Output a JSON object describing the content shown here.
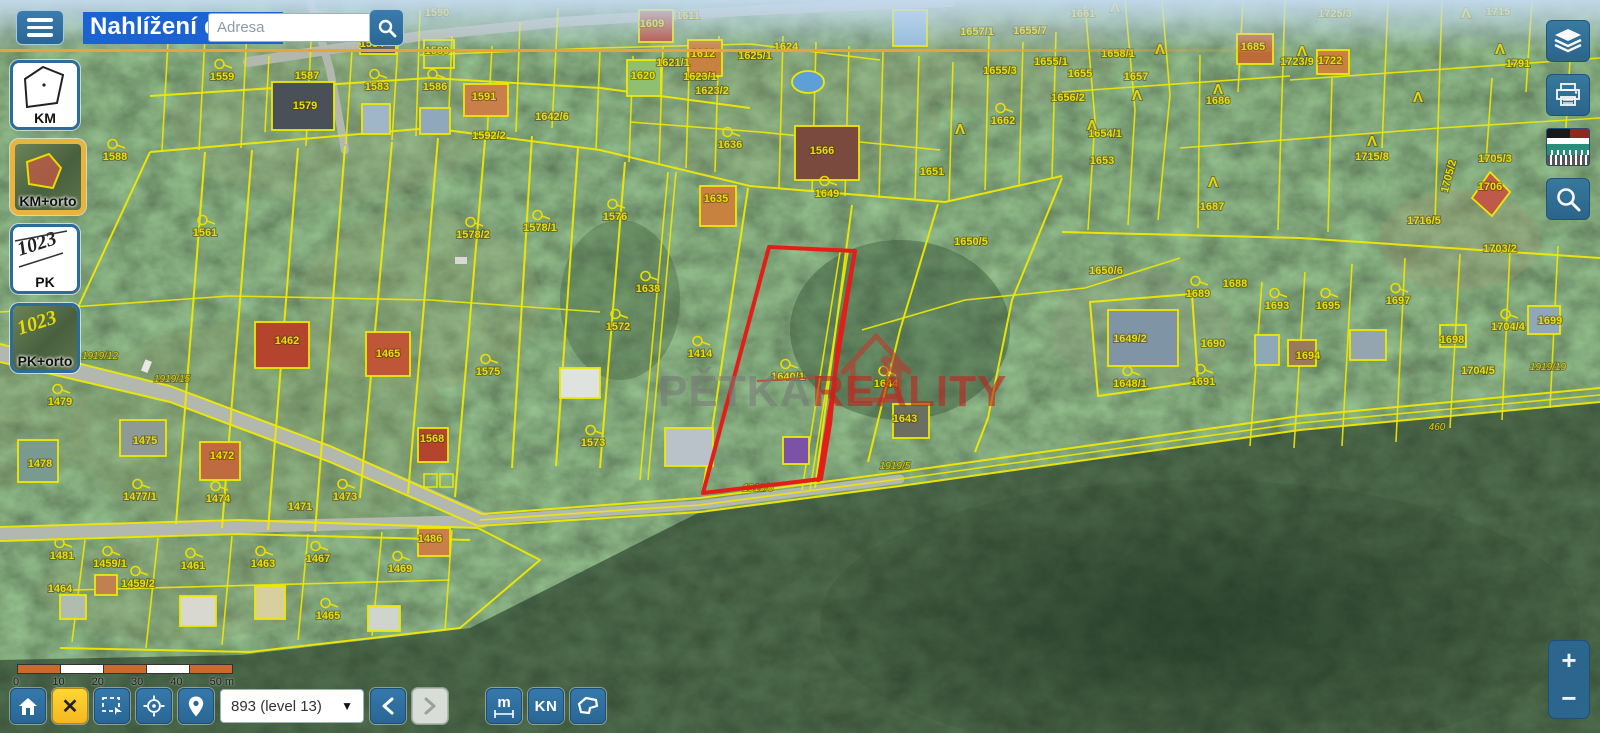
{
  "header": {
    "title": "Nahlížení do KN",
    "search_placeholder": "Adresa"
  },
  "layer_buttons": [
    {
      "id": "km",
      "label": "KM",
      "active": false
    },
    {
      "id": "km-orto",
      "label": "KM+orto",
      "active": true
    },
    {
      "id": "pk",
      "label": "PK",
      "active": false
    },
    {
      "id": "pk-orto",
      "label": "PK+orto",
      "active": false
    }
  ],
  "layer_thumb_text": {
    "pk": "1023",
    "pk_orto": "1023"
  },
  "right_tools": [
    {
      "id": "layers",
      "name": "map-layers"
    },
    {
      "id": "print",
      "name": "print-map"
    },
    {
      "id": "legend",
      "name": "legend-preview"
    },
    {
      "id": "search",
      "name": "search-map"
    }
  ],
  "toolbar": {
    "clear_label": "✕",
    "measure_label": "m",
    "kn_label": "KN",
    "zoom_level": "893 (level 13)",
    "caret": "▼"
  },
  "scalebar": {
    "ticks": [
      "0",
      "10",
      "20",
      "30",
      "40"
    ],
    "last_tick": "50 m"
  },
  "zoom_controls": {
    "plus": "+",
    "minus": "−"
  },
  "watermark": {
    "part1": "PĚTKA",
    "part2": "REALITY"
  },
  "colors": {
    "accent_blue": "#2a6694",
    "active_orange": "#e9b43d",
    "parcel_yellow": "#efe900",
    "selected_red": "#e31e18",
    "warn_yellow": "#f4b81f",
    "scale_orange": "#c96a2e"
  },
  "map": {
    "labels": [
      {
        "t": "1559",
        "x": 222,
        "y": 80,
        "f": 1
      },
      {
        "t": "1587",
        "x": 307,
        "y": 79
      },
      {
        "t": "1579",
        "x": 305,
        "y": 109
      },
      {
        "t": "1584",
        "x": 372,
        "y": 47
      },
      {
        "t": "1583",
        "x": 377,
        "y": 90,
        "f": 1
      },
      {
        "t": "1590",
        "x": 437,
        "y": 16
      },
      {
        "t": "1589",
        "x": 437,
        "y": 54
      },
      {
        "t": "1586",
        "x": 435,
        "y": 90,
        "f": 1
      },
      {
        "t": "1591",
        "x": 484,
        "y": 100
      },
      {
        "t": "1592/2",
        "x": 489,
        "y": 139
      },
      {
        "t": "1642/6",
        "x": 552,
        "y": 120
      },
      {
        "t": "1588",
        "x": 115,
        "y": 160,
        "f": 1
      },
      {
        "t": "1561",
        "x": 205,
        "y": 236,
        "f": 1
      },
      {
        "t": "1578/2",
        "x": 473,
        "y": 238,
        "f": 1
      },
      {
        "t": "1578/1",
        "x": 540,
        "y": 231,
        "f": 1
      },
      {
        "t": "1576",
        "x": 615,
        "y": 220,
        "f": 1
      },
      {
        "t": "1575",
        "x": 488,
        "y": 375,
        "f": 1
      },
      {
        "t": "1572",
        "x": 618,
        "y": 330,
        "f": 1
      },
      {
        "t": "1573",
        "x": 593,
        "y": 446,
        "f": 1
      },
      {
        "t": "1568",
        "x": 432,
        "y": 442
      },
      {
        "t": "1609",
        "x": 652,
        "y": 27
      },
      {
        "t": "1611",
        "x": 688,
        "y": 19
      },
      {
        "t": "1612",
        "x": 703,
        "y": 57
      },
      {
        "t": "1620",
        "x": 643,
        "y": 79
      },
      {
        "t": "1621/1",
        "x": 673,
        "y": 66
      },
      {
        "t": "1623/1",
        "x": 700,
        "y": 80
      },
      {
        "t": "1623/2",
        "x": 712,
        "y": 94
      },
      {
        "t": "1625/1",
        "x": 755,
        "y": 59
      },
      {
        "t": "1624",
        "x": 786,
        "y": 50
      },
      {
        "t": "1636",
        "x": 730,
        "y": 148,
        "f": 1
      },
      {
        "t": "1566",
        "x": 822,
        "y": 154
      },
      {
        "t": "1649",
        "x": 827,
        "y": 197,
        "f": 1
      },
      {
        "t": "1635",
        "x": 716,
        "y": 202
      },
      {
        "t": "1651",
        "x": 932,
        "y": 175
      },
      {
        "t": "1662",
        "x": 1003,
        "y": 124,
        "f": 1
      },
      {
        "t": "1657/1",
        "x": 977,
        "y": 35
      },
      {
        "t": "1655/7",
        "x": 1030,
        "y": 34
      },
      {
        "t": "1655/3",
        "x": 1000,
        "y": 74
      },
      {
        "t": "1655/1",
        "x": 1051,
        "y": 65
      },
      {
        "t": "1656/2",
        "x": 1068,
        "y": 101
      },
      {
        "t": "1650/5",
        "x": 971,
        "y": 245
      },
      {
        "t": "1661",
        "x": 1083,
        "y": 17
      },
      {
        "t": "1658/1",
        "x": 1118,
        "y": 57
      },
      {
        "t": "1655",
        "x": 1080,
        "y": 77
      },
      {
        "t": "1657",
        "x": 1136,
        "y": 80
      },
      {
        "t": "1654/1",
        "x": 1105,
        "y": 137
      },
      {
        "t": "1653",
        "x": 1102,
        "y": 164
      },
      {
        "t": "1686",
        "x": 1218,
        "y": 104
      },
      {
        "t": "1685",
        "x": 1253,
        "y": 50
      },
      {
        "t": "1687",
        "x": 1212,
        "y": 210
      },
      {
        "t": "1723/9",
        "x": 1297,
        "y": 65
      },
      {
        "t": "1722",
        "x": 1330,
        "y": 64
      },
      {
        "t": "1725/3",
        "x": 1335,
        "y": 17
      },
      {
        "t": "1715",
        "x": 1498,
        "y": 15
      },
      {
        "t": "1791",
        "x": 1518,
        "y": 67
      },
      {
        "t": "1715/8",
        "x": 1372,
        "y": 160
      },
      {
        "t": "1705/3",
        "x": 1495,
        "y": 162
      },
      {
        "t": "1706",
        "x": 1490,
        "y": 190
      },
      {
        "t": "1705/2",
        "x": 1452,
        "y": 177,
        "r": -75
      },
      {
        "t": "1716/5",
        "x": 1424,
        "y": 224
      },
      {
        "t": "1703/2",
        "x": 1500,
        "y": 252
      },
      {
        "t": "1650/6",
        "x": 1106,
        "y": 274
      },
      {
        "t": "1689",
        "x": 1198,
        "y": 297,
        "f": 1
      },
      {
        "t": "1688",
        "x": 1235,
        "y": 287
      },
      {
        "t": "1693",
        "x": 1277,
        "y": 309,
        "f": 1
      },
      {
        "t": "1695",
        "x": 1328,
        "y": 309,
        "f": 1
      },
      {
        "t": "1697",
        "x": 1398,
        "y": 304,
        "f": 1
      },
      {
        "t": "1649/2",
        "x": 1130,
        "y": 342
      },
      {
        "t": "1690",
        "x": 1213,
        "y": 347
      },
      {
        "t": "1691",
        "x": 1203,
        "y": 385,
        "f": 1
      },
      {
        "t": "1694",
        "x": 1308,
        "y": 359
      },
      {
        "t": "1648/1",
        "x": 1130,
        "y": 387,
        "f": 1
      },
      {
        "t": "1698",
        "x": 1452,
        "y": 343
      },
      {
        "t": "1704/4",
        "x": 1508,
        "y": 330,
        "f": 1
      },
      {
        "t": "1699",
        "x": 1550,
        "y": 324
      },
      {
        "t": "1704/5",
        "x": 1478,
        "y": 374
      },
      {
        "t": "1414",
        "x": 700,
        "y": 357,
        "f": 1
      },
      {
        "t": "1638",
        "x": 648,
        "y": 292,
        "f": 1
      },
      {
        "t": "1640/1",
        "x": 788,
        "y": 380,
        "f": 1
      },
      {
        "t": "1644",
        "x": 886,
        "y": 387,
        "f": 1
      },
      {
        "t": "1643",
        "x": 905,
        "y": 422
      },
      {
        "t": "1462",
        "x": 287,
        "y": 344
      },
      {
        "t": "1465",
        "x": 388,
        "y": 357
      },
      {
        "t": "1479",
        "x": 60,
        "y": 405,
        "f": 1
      },
      {
        "t": "1478",
        "x": 40,
        "y": 467
      },
      {
        "t": "1475",
        "x": 145,
        "y": 444
      },
      {
        "t": "1472",
        "x": 222,
        "y": 459
      },
      {
        "t": "1477/1",
        "x": 140,
        "y": 500,
        "f": 1
      },
      {
        "t": "1474",
        "x": 218,
        "y": 502,
        "f": 1
      },
      {
        "t": "1473",
        "x": 345,
        "y": 500,
        "f": 1
      },
      {
        "t": "1471",
        "x": 300,
        "y": 510
      },
      {
        "t": "1481",
        "x": 62,
        "y": 559,
        "f": 1
      },
      {
        "t": "1459/1",
        "x": 110,
        "y": 567,
        "f": 1
      },
      {
        "t": "1459/2",
        "x": 138,
        "y": 587,
        "f": 1
      },
      {
        "t": "1461",
        "x": 193,
        "y": 569,
        "f": 1
      },
      {
        "t": "1463",
        "x": 263,
        "y": 567,
        "f": 1
      },
      {
        "t": "1464",
        "x": 60,
        "y": 592
      },
      {
        "t": "1486",
        "x": 430,
        "y": 542
      },
      {
        "t": "1469",
        "x": 400,
        "y": 572,
        "f": 1
      },
      {
        "t": "1467",
        "x": 318,
        "y": 562,
        "f": 1
      },
      {
        "t": "1465",
        "x": 328,
        "y": 619,
        "f": 1
      },
      {
        "t": "1919/23",
        "x": 32,
        "y": 367,
        "c": "road"
      },
      {
        "t": "1919/12",
        "x": 100,
        "y": 359,
        "c": "road"
      },
      {
        "t": "1919/15",
        "x": 172,
        "y": 382,
        "c": "road"
      },
      {
        "t": "1919/5",
        "x": 895,
        "y": 469,
        "c": "road"
      },
      {
        "t": "1919/6",
        "x": 758,
        "y": 491,
        "c": "road"
      },
      {
        "t": "1919/19",
        "x": 1548,
        "y": 370,
        "c": "road"
      },
      {
        "t": "460",
        "x": 1437,
        "y": 430,
        "c": "road"
      },
      {
        "t": "Λ",
        "x": 1160,
        "y": 54,
        "c": "tree"
      },
      {
        "t": "Λ",
        "x": 1137,
        "y": 100,
        "c": "tree"
      },
      {
        "t": "Λ",
        "x": 1092,
        "y": 130,
        "c": "tree"
      },
      {
        "t": "Λ",
        "x": 1218,
        "y": 94,
        "c": "tree"
      },
      {
        "t": "Λ",
        "x": 1213,
        "y": 187,
        "c": "tree"
      },
      {
        "t": "Λ",
        "x": 1302,
        "y": 56,
        "c": "tree"
      },
      {
        "t": "Λ",
        "x": 1372,
        "y": 146,
        "c": "tree"
      },
      {
        "t": "Λ",
        "x": 1500,
        "y": 54,
        "c": "tree"
      },
      {
        "t": "Λ",
        "x": 1466,
        "y": 18,
        "c": "tree"
      },
      {
        "t": "Λ",
        "x": 960,
        "y": 134,
        "c": "tree"
      },
      {
        "t": "Λ",
        "x": 1115,
        "y": 12,
        "c": "tree"
      },
      {
        "t": "Λ",
        "x": 1418,
        "y": 102,
        "c": "tree"
      }
    ]
  }
}
